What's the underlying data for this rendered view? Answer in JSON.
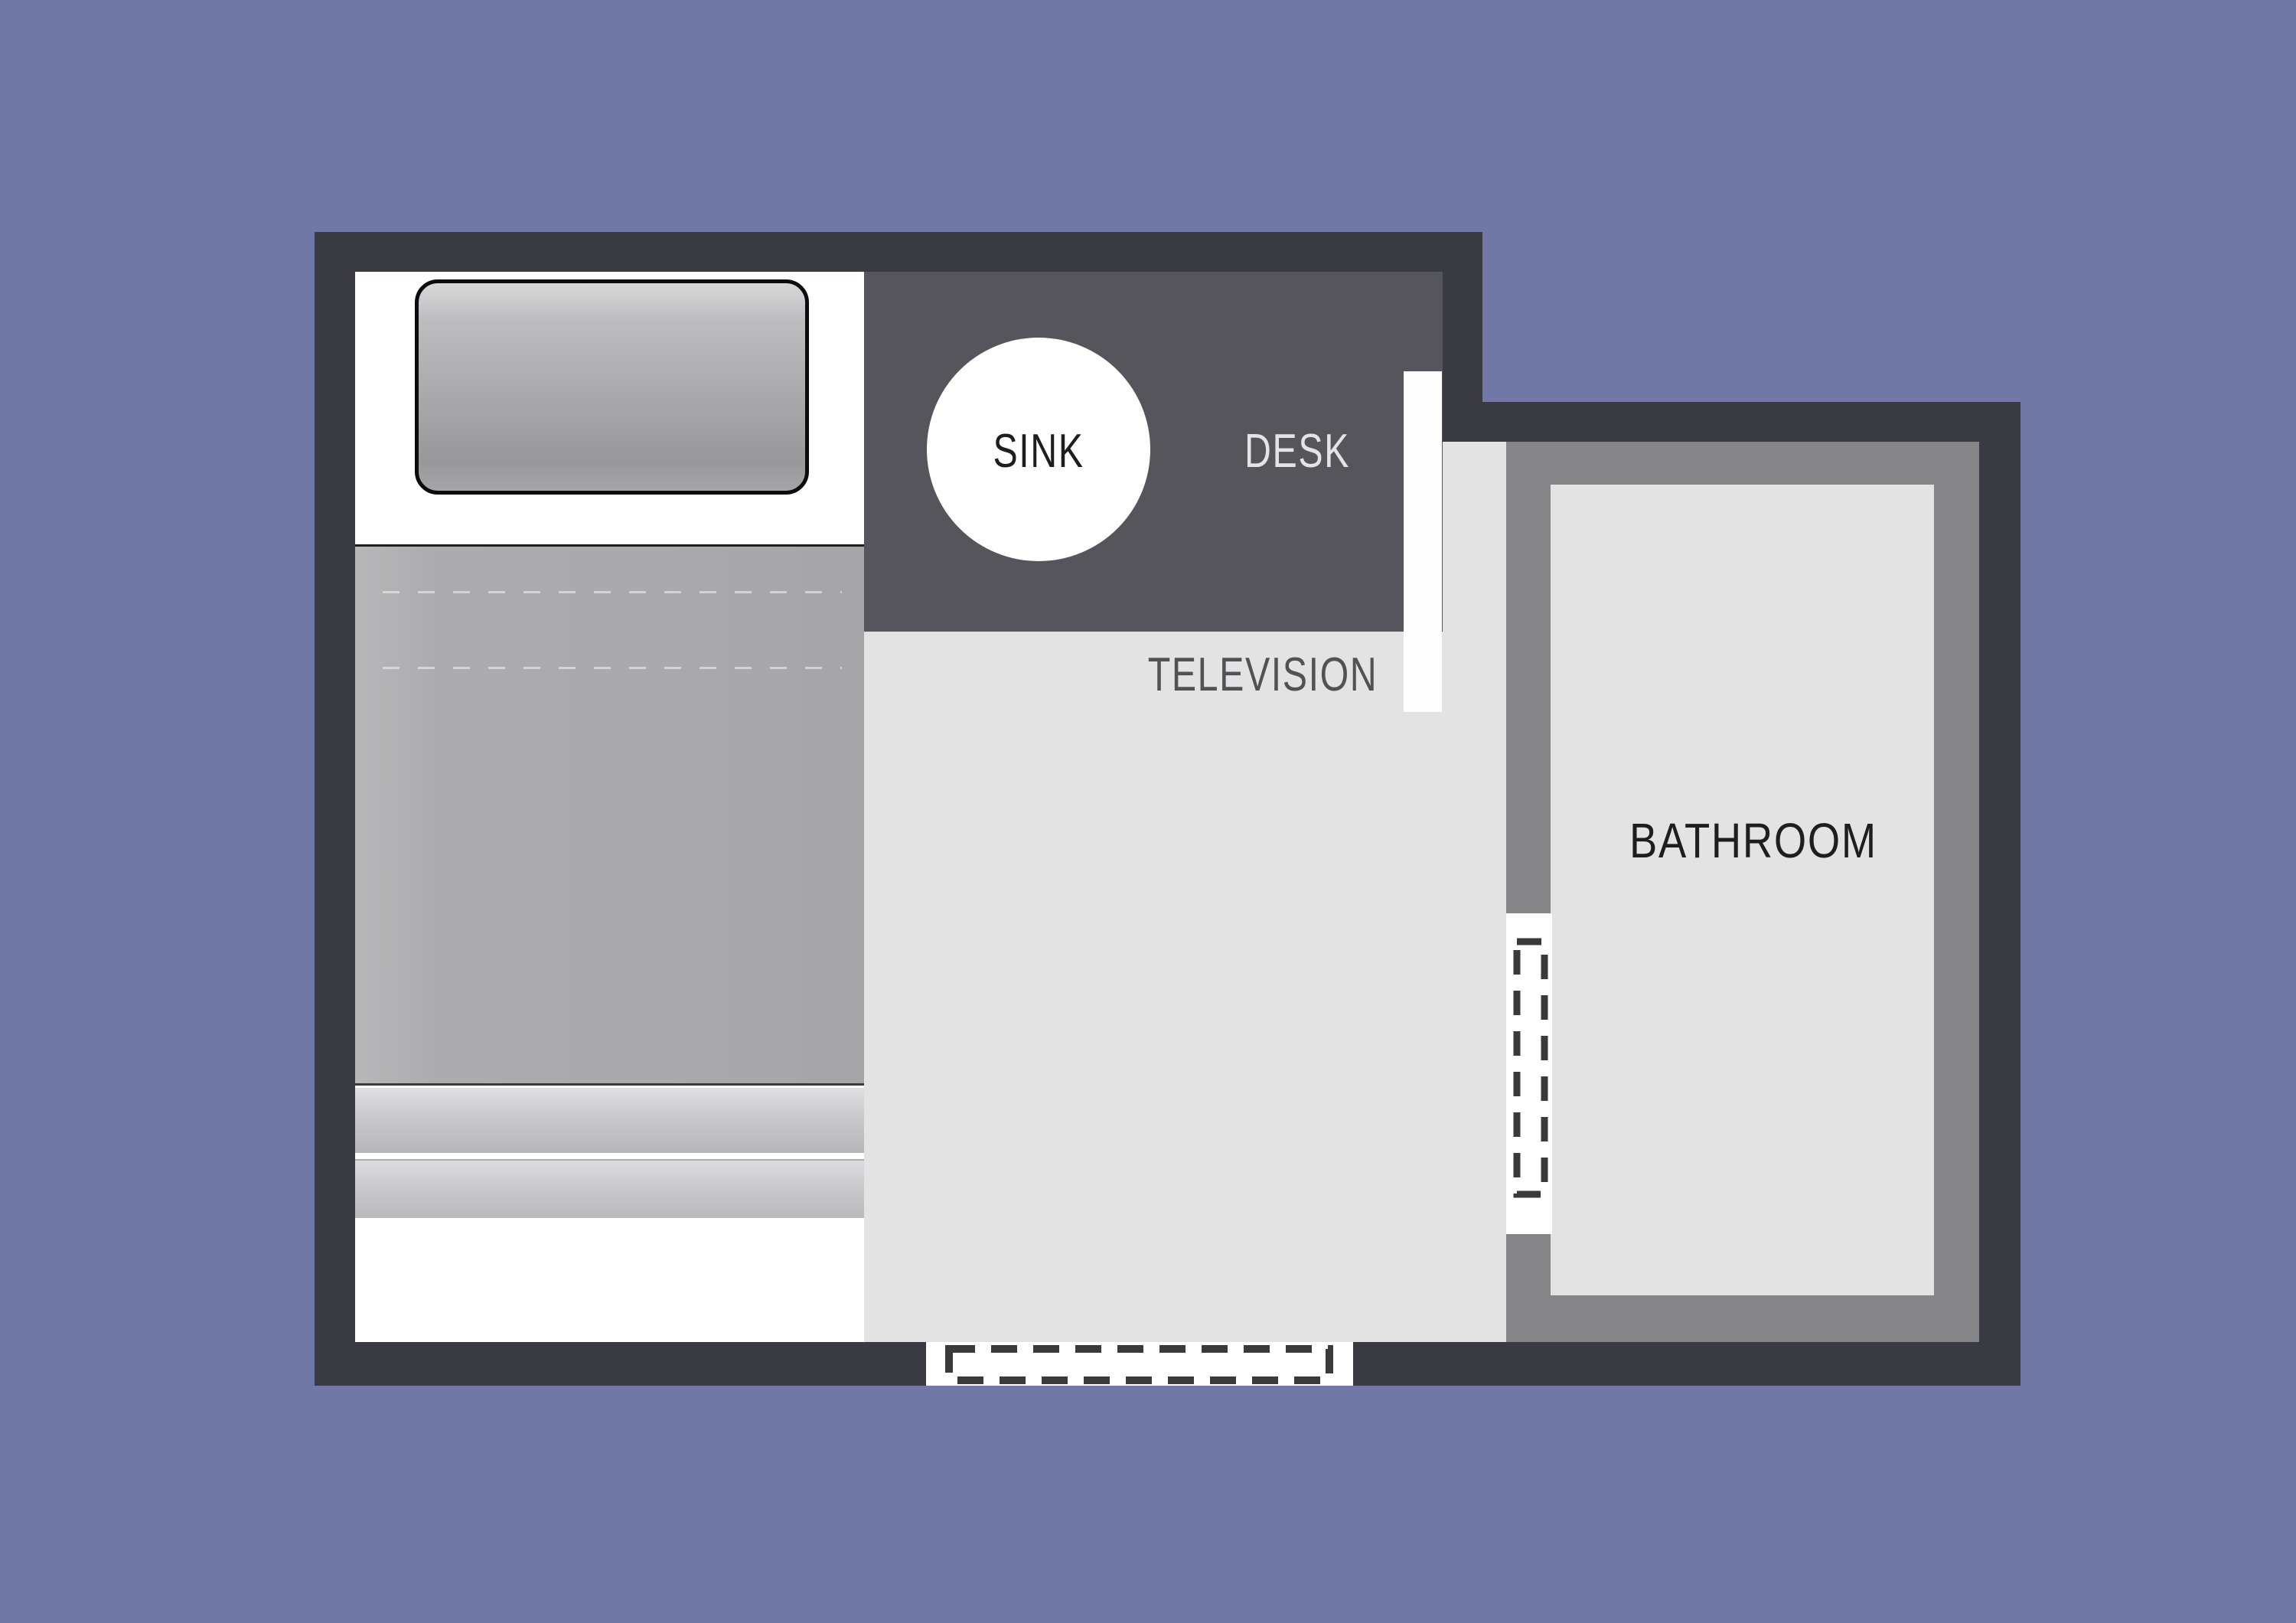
{
  "page": {
    "type": "floor-plan-diagram",
    "description": "Top-down floor plan of a single room with bed, sink/desk counter, television and bathroom"
  },
  "labels": {
    "sink": "SINK",
    "desk": "DESK",
    "television": "TELEVISION",
    "bathroom": "BATHROOM"
  },
  "icons": [
    {
      "name": "sink-circle",
      "meaning": "round sink basin"
    },
    {
      "name": "television-bar",
      "meaning": "wall-mounted television"
    },
    {
      "name": "pillow",
      "meaning": "bed pillow"
    },
    {
      "name": "mattress",
      "meaning": "bed mattress"
    },
    {
      "name": "entry-door-dashed",
      "meaning": "door opening / swing marker"
    },
    {
      "name": "bathroom-door-dashed",
      "meaning": "door opening / swing marker"
    }
  ],
  "colors": {
    "background": "#7078A5",
    "wall": "#3A3A42",
    "counter": "#55555B",
    "floor": "#E3E3E4",
    "bathroom-wall": "#858587",
    "bathroom-floor": "#E3E3E4",
    "bed-sheet": "#FFFFFF",
    "mattress": "#ABABAD",
    "door-dash": "#3A3A3A",
    "label-dark": "#1E1E1E",
    "label-light": "#E4E4E4",
    "label-gray": "#515156"
  }
}
